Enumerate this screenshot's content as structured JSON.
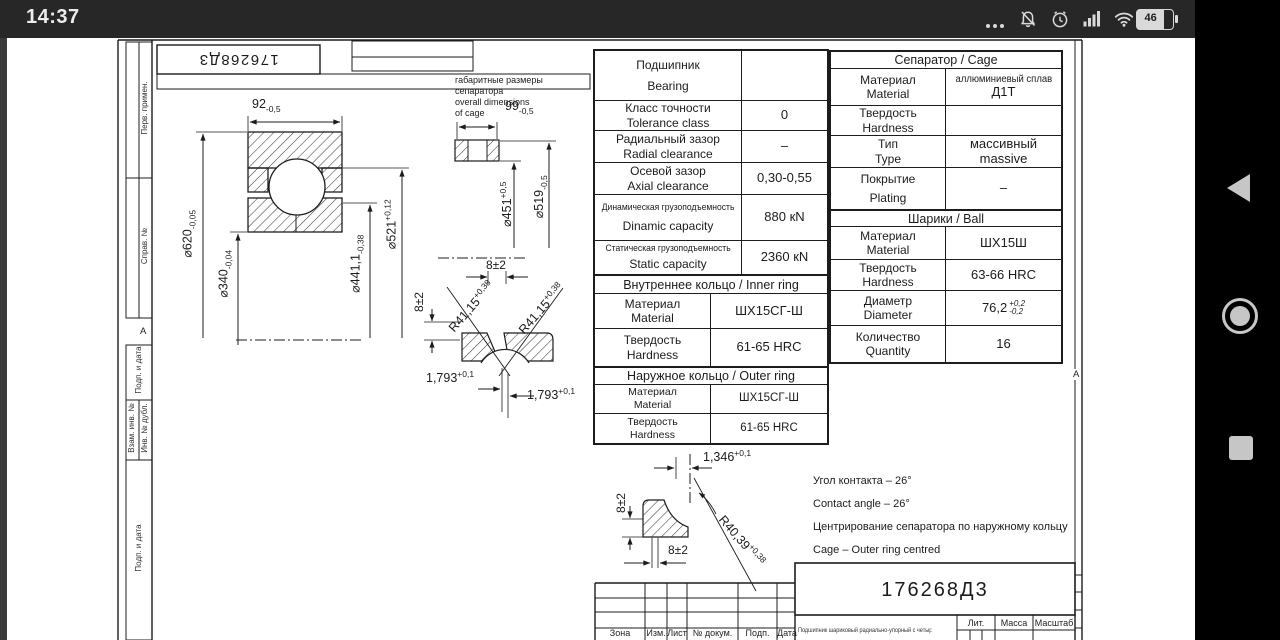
{
  "status_bar": {
    "time": "14:37",
    "battery": "46"
  },
  "doc": {
    "number_top": "176268Д3",
    "margin": {
      "marker_left": "А",
      "marker_right": "А",
      "cells": [
        "Перв. примен.",
        "Справ. №",
        "Подп. и дата",
        "Взам. инв. №",
        "Инв. № дубл.",
        "Подп. и дата"
      ]
    },
    "cage_note": {
      "l1": "габаритные размеры",
      "l2": "сепаратора",
      "l3": "overall dimensions",
      "l4": "of cage"
    },
    "dims": {
      "w92": {
        "v": "92",
        "sub": "-0,5"
      },
      "w99": {
        "v": "99",
        "sub": "-0,5"
      },
      "d620": {
        "v": "⌀620",
        "sub": "-0,05"
      },
      "d340": {
        "v": "⌀340",
        "sub": "-0,04"
      },
      "d441": {
        "v": "⌀441,1",
        "sub": "-0,38"
      },
      "d521": {
        "v": "⌀521",
        "sup": "+0,12"
      },
      "d451": {
        "v": "⌀451",
        "sup": "+0,5"
      },
      "d519": {
        "v": "⌀519",
        "sub": "-0,5"
      },
      "off8_top": "8±2",
      "off8_left": "8±2",
      "off8_v": "8±2",
      "off8_h": "8±2",
      "r_inner_l": {
        "v": "R41,15",
        "sup": "+0,38"
      },
      "r_inner_r": {
        "v": "R41,15",
        "sup": "+0,38"
      },
      "g1793_l": {
        "v": "1,793",
        "sup": "+0,1"
      },
      "g1793_r": {
        "v": "1,793",
        "sup": "+0,1"
      },
      "g1346": {
        "v": "1,346",
        "sup": "+0,1"
      },
      "r_outer": {
        "v": "R40,39",
        "sup": "+0,38"
      }
    },
    "bearing_table": {
      "title_ru": "Подшипник",
      "title_en": "Bearing",
      "rows": [
        {
          "ru": "Класс точности",
          "en": "Tolerance class",
          "val": "0"
        },
        {
          "ru": "Радиальный зазор",
          "en": "Radial clearance",
          "val": "–"
        },
        {
          "ru": "Осевой зазор",
          "en": "Axial clearance",
          "val": "0,30-0,55"
        },
        {
          "ru": "Динамическая грузоподъемность",
          "en": "Dinamic capacity",
          "val": "880 кN"
        },
        {
          "ru": "Статическая грузоподъемность",
          "en": "Static capacity",
          "val": "2360 кN"
        }
      ],
      "inner_title": "Внутреннее кольцо / Inner ring",
      "inner_rows": [
        {
          "ru": "Материал",
          "en": "Material",
          "val": "ШХ15СГ-Ш"
        },
        {
          "ru": "Твердость",
          "en": "Hardness",
          "val": "61-65 HRC"
        }
      ],
      "outer_title": "Наружное кольцо / Outer ring",
      "outer_rows": [
        {
          "ru": "Материал",
          "en": "Material",
          "val": "ШХ15СГ-Ш"
        },
        {
          "ru": "Твердость",
          "en": "Hardness",
          "val": "61-65 HRC"
        }
      ]
    },
    "cage_table": {
      "title": "Сепаратор / Cage",
      "rows": [
        {
          "ru": "Материал",
          "en": "Material",
          "v1": "аллюминиевый сплав",
          "v2": "Д1Т"
        },
        {
          "ru": "Твердость",
          "en": "Hardness",
          "v1": "",
          "v2": ""
        },
        {
          "ru": "Тип",
          "en": "Type",
          "v1": "массивный",
          "v2": "massive"
        },
        {
          "ru": "Покрытие",
          "en": "Plating",
          "v1": "–",
          "v2": ""
        }
      ]
    },
    "ball_table": {
      "title": "Шарики / Ball",
      "rows": [
        {
          "ru": "Материал",
          "en": "Material",
          "val": "ШХ15Ш"
        },
        {
          "ru": "Твердость",
          "en": "Hardness",
          "val": "63-66 HRC"
        },
        {
          "ru": "Диаметр",
          "en": "Diameter",
          "val": "76,2",
          "sup": "+0,2",
          "sub": "-0,2"
        },
        {
          "ru": "Количество",
          "en": "Quantity",
          "val": "16"
        }
      ]
    },
    "notes": [
      "Угол контакта – 26°",
      "Contact angle – 26°",
      "Центрирование сепаратора по  наружному кольцу",
      "Cage – Outer ring centred"
    ],
    "title_block": {
      "number": "176268Д3",
      "cols": [
        "Зона",
        "Изм.",
        "Лист",
        "№ докум.",
        "Подп.",
        "Дата"
      ],
      "description": "Подшипник шариковый радиально-упорный с четырехточечным контактом",
      "lit": "Лит.",
      "mass": "Масса",
      "scale": "Масштаб"
    }
  }
}
